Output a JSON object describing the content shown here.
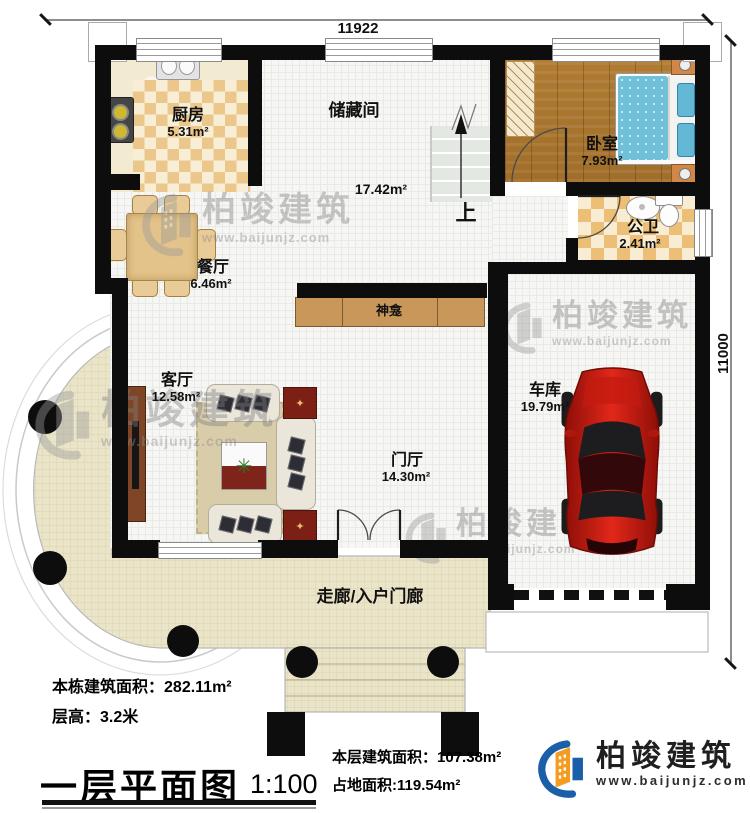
{
  "dimensions": {
    "width": "11922",
    "height": "11000"
  },
  "rooms": {
    "kitchen": {
      "name": "厨房",
      "area": "5.31m²"
    },
    "storage": {
      "name": "储藏间",
      "area": "17.42m²"
    },
    "bedroom": {
      "name": "卧室",
      "area": "7.93m²"
    },
    "bathroom": {
      "name": "公卫",
      "area": "2.41m²"
    },
    "dining": {
      "name": "餐厅",
      "area": "6.46m²"
    },
    "living": {
      "name": "客厅",
      "area": "12.58m²"
    },
    "hall": {
      "name": "门厅",
      "area": "14.30m²"
    },
    "garage": {
      "name": "车库",
      "area": "19.79m²"
    }
  },
  "features": {
    "shrine": "神龛",
    "stairs_up": "上",
    "corridor": "走廊/入户门廊"
  },
  "title_block": {
    "building_area_label": "本栋建筑面积：",
    "building_area_value": "282.11m²",
    "floor_height_label": "层高：",
    "floor_height_value": "3.2米",
    "plan_title": "一层平面图",
    "plan_scale": "1:100",
    "floor_area_label": "本层建筑面积：",
    "floor_area_value": "107.38m²",
    "land_area_label": "占地面积:",
    "land_area_value": "119.54m²"
  },
  "brand": {
    "name": "柏竣建筑",
    "url": "www.baijunjz.com"
  },
  "watermark": {
    "name": "柏竣建筑",
    "url": "www.baijunjz.com"
  },
  "colors": {
    "wall": "#0d0d0d",
    "brand_blue": "#1a5fa8",
    "brand_orange": "#f49c1f",
    "car_red": "#c8160c"
  }
}
